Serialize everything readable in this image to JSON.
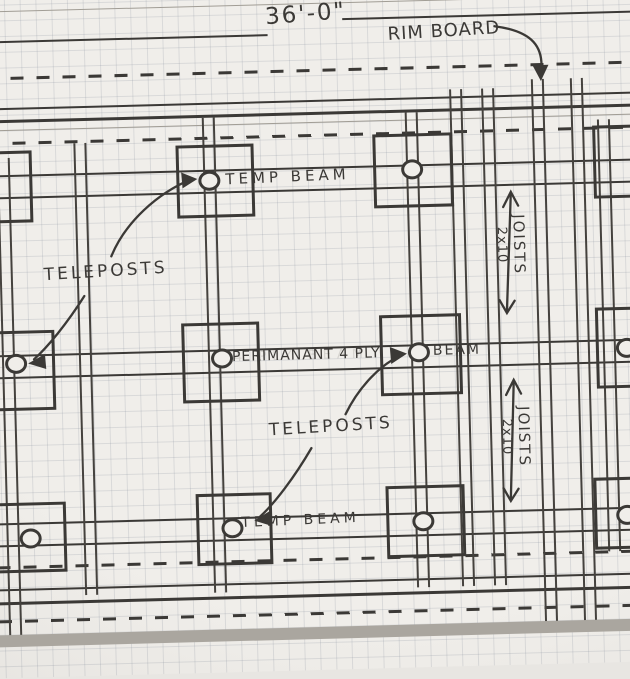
{
  "sketch": {
    "type": "hand-drawn floor framing plan on graph paper",
    "dimension_label": "36'-0\"",
    "rim_board_label": "RIM BOARD",
    "temp_beam_top_label": "TEMP BEAM",
    "temp_beam_bottom_label": "TEMP BEAM",
    "teleposts_upper_label": "TELEPOSTS",
    "teleposts_lower_label": "TELEPOSTS",
    "permanent_beam_label": "PERIMANANT 4 PLY",
    "permanent_beam_label_2": "BEAM",
    "erased_note": "4 PLY BEAM",
    "joists_upper": {
      "line1": "JOISTS",
      "line2": "2x10"
    },
    "joists_lower": {
      "line1": "JOISTS",
      "line2": "2x10"
    },
    "colors": {
      "paper": "#f0eeea",
      "grid_line": "#bcc2cb",
      "pencil": "#3b3936",
      "paper_edge": "#aaa69f"
    }
  }
}
